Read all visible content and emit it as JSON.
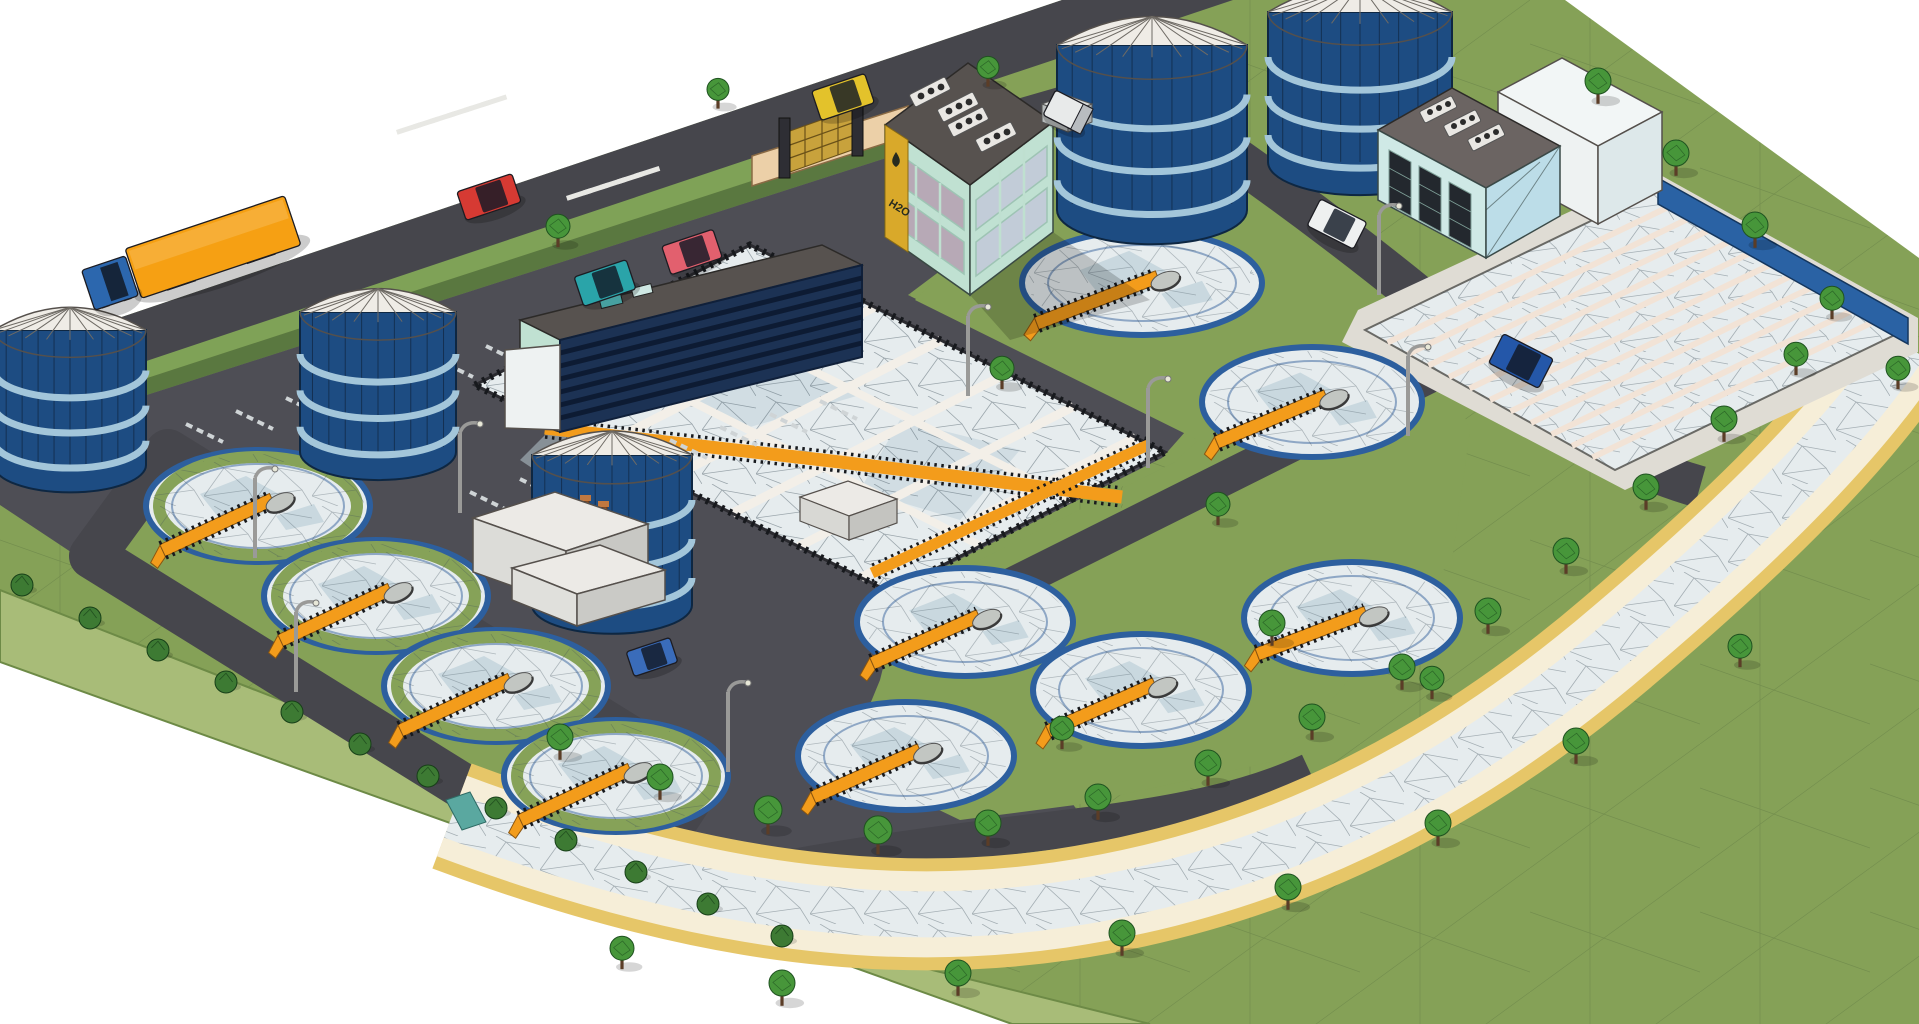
{
  "scene": {
    "title": "Wastewater treatment plant – low-poly isometric 3D model render",
    "background": "#ffffff"
  },
  "signage": {
    "building_sign": "H2O"
  },
  "counts": {
    "circular_clarifiers": 10,
    "storage_tanks": 5,
    "aeration_basins": 1,
    "lane_basins": 1,
    "vehicles": 10,
    "light_poles": 8,
    "trees": 36,
    "bushes": 12
  },
  "palette": {
    "bg": "#ffffff",
    "grass": "#85a157",
    "slope": "#a8bc78",
    "road": "#46464c",
    "pavement": "#4e4e55",
    "hedgeTop": "#7fa257",
    "hedgeSide": "#5a7840",
    "water": "#e6ecee",
    "waterShade": "#bfd2da",
    "beam": "#f3efe8",
    "ring": "#2d5f9e",
    "orange": "#f39c1b",
    "rail": "#17191d",
    "tank": "#1d4c82",
    "tankBand": "#a3c6da",
    "dome": "#efece6",
    "mint": "#c0e1d2",
    "glass": "#b7a9b6",
    "glassBlue": "#c2ccd8",
    "roof": "#57524f",
    "navy": "#1c3254",
    "navyStripe": "#0d1b33",
    "lightBlue": "#cfe9e6",
    "lightBlue2": "#bcdde8",
    "whiteWall": "#eef2f2",
    "sand": "#efe0a6",
    "sandEdge": "#e6c668",
    "sandPale": "#f6eed8",
    "tree": "#47963a",
    "treeDark": "#1f5220",
    "bush": "#3d7a33",
    "trunk": "#5b3d27",
    "signYellow": "#d9a92a",
    "signDark": "#272b1f",
    "pole": "#9a9a98",
    "tan": "#ecd0a8",
    "pillar": "#2e2e34",
    "gate": "#c8a23c",
    "channelBlue": "#2a62a4"
  },
  "storage_tanks": [
    {
      "x": 70,
      "y": 330,
      "r": 76,
      "h": 135
    },
    {
      "x": 378,
      "y": 312,
      "r": 78,
      "h": 140
    },
    {
      "x": 612,
      "y": 455,
      "r": 80,
      "h": 150
    },
    {
      "x": 1152,
      "y": 45,
      "r": 95,
      "h": 165
    },
    {
      "x": 1360,
      "y": 12,
      "r": 92,
      "h": 150
    }
  ],
  "clarifiers": [
    {
      "cx": 258,
      "cy": 506,
      "rx": 112,
      "ry": 56,
      "deg": -25,
      "green": true
    },
    {
      "cx": 376,
      "cy": 596,
      "rx": 112,
      "ry": 56,
      "deg": -25,
      "green": true
    },
    {
      "cx": 496,
      "cy": 686,
      "rx": 112,
      "ry": 56,
      "deg": -25,
      "green": true
    },
    {
      "cx": 616,
      "cy": 776,
      "rx": 112,
      "ry": 56,
      "deg": -25,
      "green": true
    },
    {
      "cx": 965,
      "cy": 622,
      "rx": 108,
      "ry": 54,
      "deg": -24,
      "green": false
    },
    {
      "cx": 906,
      "cy": 756,
      "rx": 108,
      "ry": 54,
      "deg": -24,
      "green": false
    },
    {
      "cx": 1142,
      "cy": 283,
      "rx": 120,
      "ry": 52,
      "deg": -21,
      "green": false
    },
    {
      "cx": 1312,
      "cy": 402,
      "rx": 110,
      "ry": 55,
      "deg": -23,
      "green": false
    },
    {
      "cx": 1352,
      "cy": 618,
      "rx": 108,
      "ry": 56,
      "deg": -21,
      "green": false
    },
    {
      "cx": 1141,
      "cy": 690,
      "rx": 108,
      "ry": 56,
      "deg": -24,
      "green": false
    }
  ],
  "vehicles": [
    {
      "kind": "trailer",
      "color": "#f6a013",
      "x": 213,
      "y": 247,
      "rot": -18.5,
      "l": 168,
      "w": 52
    },
    {
      "kind": "cab",
      "color": "#2c67ae",
      "x": 110,
      "y": 283,
      "rot": -18.5,
      "l": 46,
      "w": 42
    },
    {
      "kind": "car",
      "color": "#d63a33",
      "x": 489,
      "y": 197,
      "rot": -18.5,
      "l": 58,
      "w": 30
    },
    {
      "kind": "car",
      "color": "#e3c22b",
      "x": 843,
      "y": 97,
      "rot": -18.5,
      "l": 56,
      "w": 31
    },
    {
      "kind": "car",
      "color": "#2aa4a9",
      "x": 605,
      "y": 283,
      "rot": -18.5,
      "l": 55,
      "w": 31
    },
    {
      "kind": "car",
      "color": "#e2606e",
      "x": 692,
      "y": 252,
      "rot": -18.5,
      "l": 54,
      "w": 30
    },
    {
      "kind": "car",
      "color": "#eef0f0",
      "x": 1337,
      "y": 224,
      "rot": 27,
      "l": 52,
      "w": 30
    },
    {
      "kind": "suv",
      "color": "#2457a9",
      "x": 1521,
      "y": 361,
      "rot": 27,
      "l": 56,
      "w": 33
    },
    {
      "kind": "car",
      "color": "#3a6cba",
      "x": 652,
      "y": 657,
      "rot": -18.5,
      "l": 46,
      "w": 26
    },
    {
      "kind": "box",
      "color": "#e8eaea",
      "x": 1068,
      "y": 112,
      "rot": 27,
      "l": 42,
      "w": 28
    }
  ],
  "light_poles": [
    {
      "x": 255,
      "y": 558
    },
    {
      "x": 296,
      "y": 692
    },
    {
      "x": 460,
      "y": 513
    },
    {
      "x": 728,
      "y": 772
    },
    {
      "x": 968,
      "y": 396
    },
    {
      "x": 1148,
      "y": 468
    },
    {
      "x": 1379,
      "y": 295
    },
    {
      "x": 1408,
      "y": 436
    }
  ],
  "trees": [
    {
      "x": 558,
      "y": 240,
      "s": 12
    },
    {
      "x": 718,
      "y": 102,
      "s": 11
    },
    {
      "x": 988,
      "y": 80,
      "s": 11
    },
    {
      "x": 1598,
      "y": 96,
      "s": 13
    },
    {
      "x": 1676,
      "y": 168,
      "s": 13
    },
    {
      "x": 1755,
      "y": 240,
      "s": 13
    },
    {
      "x": 1832,
      "y": 312,
      "s": 12
    },
    {
      "x": 1898,
      "y": 382,
      "s": 12
    },
    {
      "x": 1002,
      "y": 382,
      "s": 12
    },
    {
      "x": 1218,
      "y": 518,
      "s": 12
    },
    {
      "x": 1272,
      "y": 638,
      "s": 13
    },
    {
      "x": 1432,
      "y": 692,
      "s": 12
    },
    {
      "x": 1062,
      "y": 742,
      "s": 12
    },
    {
      "x": 560,
      "y": 752,
      "s": 13
    },
    {
      "x": 660,
      "y": 792,
      "s": 13
    },
    {
      "x": 768,
      "y": 826,
      "s": 14
    },
    {
      "x": 878,
      "y": 846,
      "s": 14
    },
    {
      "x": 988,
      "y": 838,
      "s": 13
    },
    {
      "x": 1098,
      "y": 812,
      "s": 13
    },
    {
      "x": 1208,
      "y": 778,
      "s": 13
    },
    {
      "x": 1312,
      "y": 732,
      "s": 13
    },
    {
      "x": 1402,
      "y": 682,
      "s": 13
    },
    {
      "x": 1488,
      "y": 626,
      "s": 13
    },
    {
      "x": 1566,
      "y": 566,
      "s": 13
    },
    {
      "x": 1646,
      "y": 502,
      "s": 13
    },
    {
      "x": 1724,
      "y": 434,
      "s": 13
    },
    {
      "x": 1796,
      "y": 368,
      "s": 12
    },
    {
      "x": 622,
      "y": 962,
      "s": 12
    },
    {
      "x": 782,
      "y": 998,
      "s": 13
    },
    {
      "x": 958,
      "y": 988,
      "s": 13
    },
    {
      "x": 1122,
      "y": 948,
      "s": 13
    },
    {
      "x": 1288,
      "y": 902,
      "s": 13
    },
    {
      "x": 1438,
      "y": 838,
      "s": 13
    },
    {
      "x": 1576,
      "y": 756,
      "s": 13
    },
    {
      "x": 1740,
      "y": 660,
      "s": 12
    }
  ],
  "bushes": [
    {
      "x": 22,
      "y": 585,
      "s": 11
    },
    {
      "x": 90,
      "y": 618,
      "s": 11
    },
    {
      "x": 158,
      "y": 650,
      "s": 11
    },
    {
      "x": 226,
      "y": 682,
      "s": 11
    },
    {
      "x": 292,
      "y": 712,
      "s": 11
    },
    {
      "x": 360,
      "y": 744,
      "s": 11
    },
    {
      "x": 428,
      "y": 776,
      "s": 11
    },
    {
      "x": 496,
      "y": 808,
      "s": 11
    },
    {
      "x": 566,
      "y": 840,
      "s": 11
    },
    {
      "x": 636,
      "y": 872,
      "s": 11
    },
    {
      "x": 708,
      "y": 904,
      "s": 11
    },
    {
      "x": 782,
      "y": 936,
      "s": 11
    }
  ],
  "road_markings": {
    "crosswalks": [
      {
        "x": 396,
        "y": 130,
        "n": 6,
        "dx": 17,
        "dy": -5.5,
        "w": 26,
        "h": 5,
        "rot": -18
      },
      {
        "x": 566,
        "y": 196,
        "n": 5,
        "dx": 17,
        "dy": -5.5,
        "w": 26,
        "h": 5,
        "rot": -18
      }
    ],
    "stall_rows": [
      {
        "x": 186,
        "y": 424,
        "n": 8,
        "dx": 50,
        "dy": -13,
        "lx": 37,
        "ly": 18
      },
      {
        "x": 470,
        "y": 492,
        "n": 8,
        "dx": 50,
        "dy": -13,
        "lx": 37,
        "ly": 18
      }
    ]
  }
}
